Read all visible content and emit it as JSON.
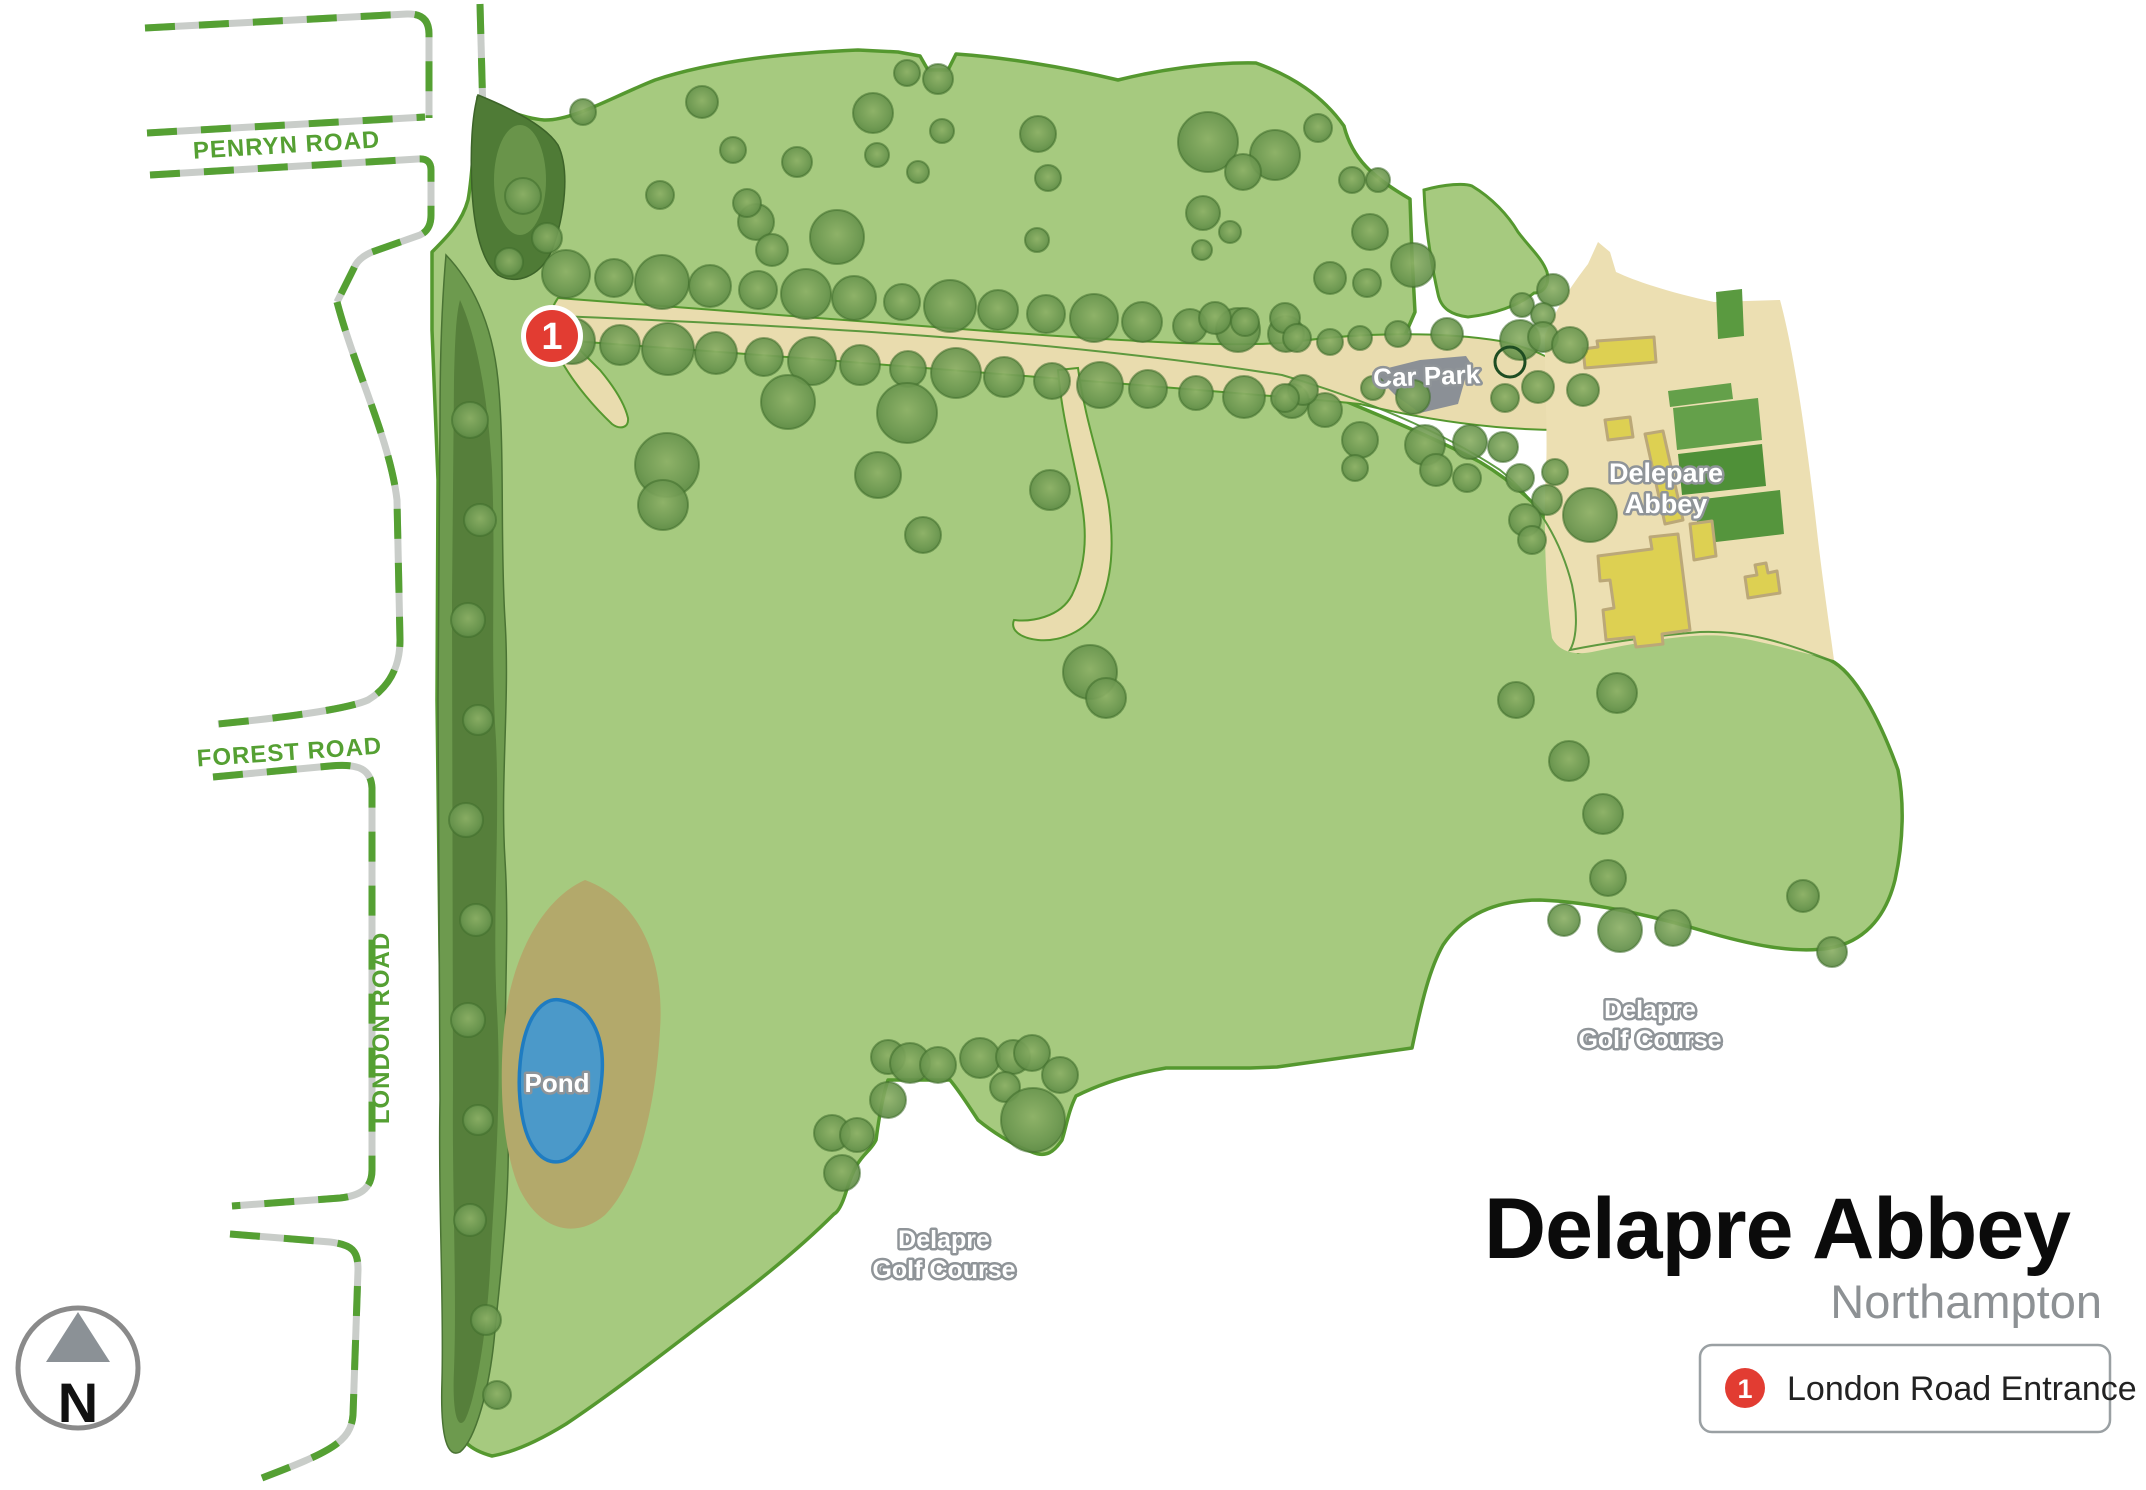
{
  "title": {
    "main": "Delapre Abbey",
    "subtitle": "Northampton"
  },
  "legend": {
    "marker_number": "1",
    "entry_label": "London Road Entrance"
  },
  "compass": {
    "north_label": "N"
  },
  "map_marker": {
    "number": "1"
  },
  "map_labels": {
    "penryn_road": "PENRYN ROAD",
    "forest_road": "FOREST ROAD",
    "london_road": "LONDON ROAD",
    "car_park": "Car Park",
    "abbey_name_line1": "Delepare",
    "abbey_name_line2": "Abbey",
    "pond": "Pond",
    "golf_east_line1": "Delapre",
    "golf_east_line2": "Golf Course",
    "golf_south_line1": "Delapre",
    "golf_south_line2": "Golf Course"
  },
  "colors": {
    "park_green": "#a6ca7f",
    "park_stroke": "#55982f",
    "tree_belt_dark": "#567f3b",
    "tree_belt_mid": "#6d9a4e",
    "path_tan": "#e9dcae",
    "abbey_grounds": "#ecdfb2",
    "building_yellow": "#ddd052",
    "building_stroke": "#bba878",
    "garden_green": "#55953d",
    "car_park_gray": "#8b9096",
    "pond_blue": "#4b99c9",
    "pond_stroke": "#1f7cc1",
    "sand_olive": "#b3a96b",
    "road_dash_green": "#55a033",
    "marker_red": "#e23c32"
  },
  "trees": [
    [
      566,
      274,
      24
    ],
    [
      614,
      278,
      19
    ],
    [
      662,
      282,
      27
    ],
    [
      710,
      286,
      21
    ],
    [
      758,
      290,
      19
    ],
    [
      806,
      294,
      25
    ],
    [
      854,
      298,
      22
    ],
    [
      902,
      302,
      18
    ],
    [
      950,
      306,
      26
    ],
    [
      998,
      310,
      20
    ],
    [
      1046,
      314,
      19
    ],
    [
      1094,
      318,
      24
    ],
    [
      1142,
      322,
      20
    ],
    [
      1190,
      326,
      17
    ],
    [
      1238,
      330,
      22
    ],
    [
      1286,
      334,
      18
    ],
    [
      572,
      341,
      23
    ],
    [
      620,
      345,
      20
    ],
    [
      668,
      349,
      26
    ],
    [
      716,
      353,
      21
    ],
    [
      764,
      357,
      19
    ],
    [
      812,
      361,
      24
    ],
    [
      860,
      365,
      20
    ],
    [
      908,
      369,
      18
    ],
    [
      956,
      373,
      25
    ],
    [
      1004,
      377,
      20
    ],
    [
      1052,
      381,
      18
    ],
    [
      1100,
      385,
      23
    ],
    [
      1148,
      389,
      19
    ],
    [
      1196,
      393,
      17
    ],
    [
      1244,
      397,
      21
    ],
    [
      1292,
      401,
      17
    ],
    [
      583,
      112,
      13
    ],
    [
      702,
      102,
      16
    ],
    [
      733,
      150,
      13
    ],
    [
      797,
      162,
      15
    ],
    [
      873,
      113,
      20
    ],
    [
      877,
      155,
      12
    ],
    [
      918,
      172,
      11
    ],
    [
      907,
      73,
      13
    ],
    [
      938,
      79,
      15
    ],
    [
      942,
      131,
      12
    ],
    [
      1038,
      134,
      18
    ],
    [
      1048,
      178,
      13
    ],
    [
      1037,
      240,
      12
    ],
    [
      837,
      237,
      27
    ],
    [
      756,
      222,
      18
    ],
    [
      772,
      250,
      16
    ],
    [
      747,
      203,
      14
    ],
    [
      660,
      195,
      14
    ],
    [
      1208,
      142,
      30
    ],
    [
      1275,
      155,
      25
    ],
    [
      1243,
      172,
      18
    ],
    [
      1318,
      128,
      14
    ],
    [
      1352,
      180,
      13
    ],
    [
      1378,
      180,
      12
    ],
    [
      1203,
      213,
      17
    ],
    [
      1230,
      232,
      11
    ],
    [
      1202,
      250,
      10
    ],
    [
      1370,
      232,
      18
    ],
    [
      1413,
      265,
      22
    ],
    [
      1330,
      278,
      16
    ],
    [
      1367,
      283,
      14
    ],
    [
      1215,
      318,
      16
    ],
    [
      1245,
      322,
      14
    ],
    [
      1285,
      318,
      15
    ],
    [
      1553,
      290,
      16
    ],
    [
      1522,
      305,
      12
    ],
    [
      1543,
      315,
      12
    ],
    [
      1297,
      338,
      14
    ],
    [
      1330,
      342,
      13
    ],
    [
      1360,
      338,
      12
    ],
    [
      1398,
      334,
      13
    ],
    [
      1447,
      334,
      16
    ],
    [
      1520,
      340,
      20
    ],
    [
      1543,
      337,
      15
    ],
    [
      1570,
      345,
      18
    ],
    [
      1583,
      390,
      16
    ],
    [
      1538,
      387,
      16
    ],
    [
      1505,
      398,
      14
    ],
    [
      1413,
      397,
      17
    ],
    [
      1373,
      388,
      12
    ],
    [
      1325,
      410,
      17
    ],
    [
      1303,
      390,
      15
    ],
    [
      1285,
      398,
      14
    ],
    [
      1360,
      440,
      18
    ],
    [
      1425,
      445,
      20
    ],
    [
      1470,
      442,
      17
    ],
    [
      1503,
      447,
      15
    ],
    [
      1436,
      470,
      16
    ],
    [
      1467,
      478,
      14
    ],
    [
      1355,
      468,
      13
    ],
    [
      1520,
      478,
      14
    ],
    [
      1555,
      472,
      13
    ],
    [
      1547,
      500,
      15
    ],
    [
      1590,
      515,
      27
    ],
    [
      1525,
      520,
      16
    ],
    [
      1532,
      540,
      14
    ],
    [
      667,
      465,
      32
    ],
    [
      663,
      505,
      25
    ],
    [
      788,
      402,
      27
    ],
    [
      907,
      413,
      30
    ],
    [
      878,
      475,
      23
    ],
    [
      923,
      535,
      18
    ],
    [
      1050,
      490,
      20
    ],
    [
      1090,
      672,
      27
    ],
    [
      1106,
      698,
      20
    ],
    [
      1516,
      700,
      18
    ],
    [
      1569,
      761,
      20
    ],
    [
      1603,
      814,
      20
    ],
    [
      1608,
      878,
      18
    ],
    [
      1620,
      930,
      22
    ],
    [
      1673,
      928,
      18
    ],
    [
      1564,
      920,
      16
    ],
    [
      1617,
      693,
      20
    ],
    [
      1803,
      896,
      16
    ],
    [
      1832,
      952,
      15
    ],
    [
      888,
      1057,
      17
    ],
    [
      910,
      1063,
      20
    ],
    [
      938,
      1065,
      18
    ],
    [
      980,
      1058,
      20
    ],
    [
      1013,
      1057,
      17
    ],
    [
      1032,
      1053,
      18
    ],
    [
      1060,
      1075,
      18
    ],
    [
      1005,
      1087,
      15
    ],
    [
      1033,
      1120,
      32
    ],
    [
      888,
      1100,
      18
    ],
    [
      832,
      1133,
      18
    ],
    [
      857,
      1135,
      17
    ],
    [
      842,
      1173,
      18
    ],
    [
      470,
      420,
      18
    ],
    [
      480,
      520,
      16
    ],
    [
      468,
      620,
      17
    ],
    [
      478,
      720,
      15
    ],
    [
      466,
      820,
      17
    ],
    [
      476,
      920,
      16
    ],
    [
      468,
      1020,
      17
    ],
    [
      478,
      1120,
      15
    ],
    [
      470,
      1220,
      16
    ],
    [
      486,
      1320,
      15
    ],
    [
      497,
      1395,
      14
    ],
    [
      523,
      196,
      18
    ],
    [
      547,
      238,
      15
    ],
    [
      509,
      262,
      14
    ]
  ],
  "ring_tree": [
    1510,
    362,
    15
  ]
}
